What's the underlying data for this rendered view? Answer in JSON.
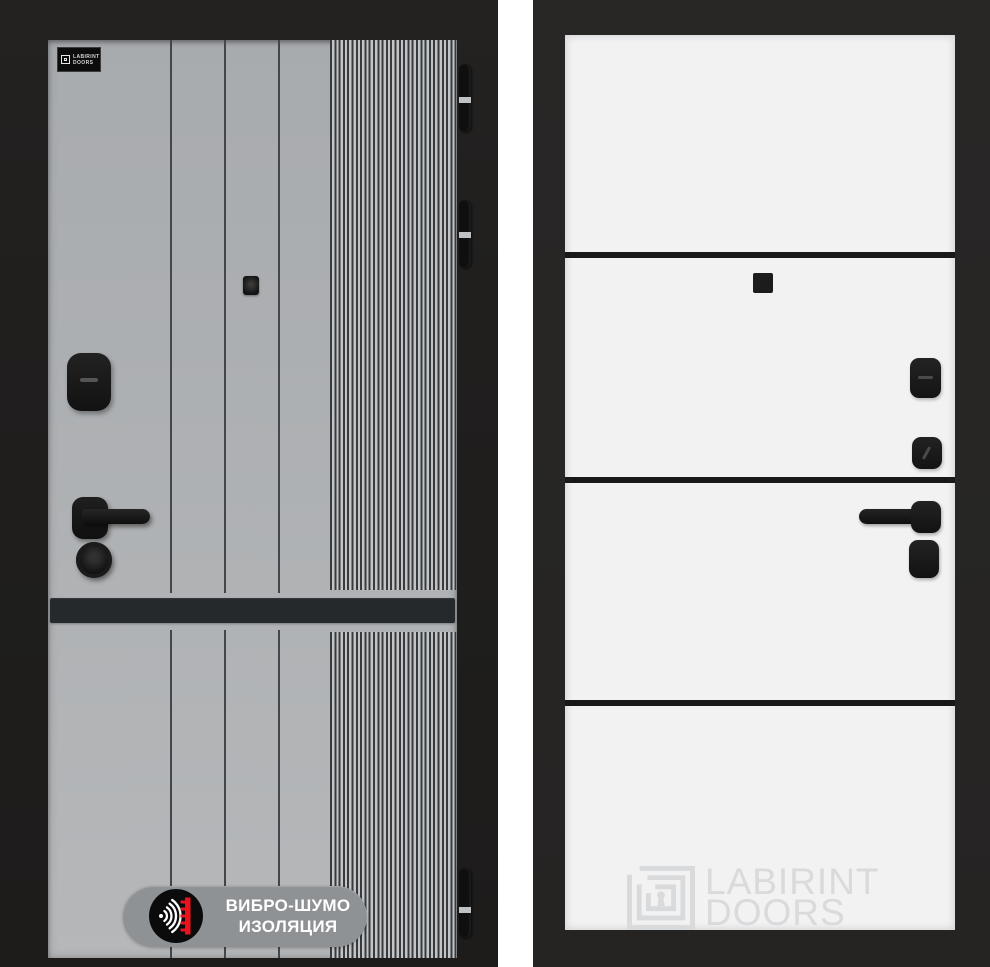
{
  "colors": {
    "page_bg": "#ffffff",
    "left_frame": "#201f1e",
    "panel_gray_top": "#a8abae",
    "panel_gray_bottom": "#b5b7b9",
    "seam_line": "#43464a",
    "rib_dark": "#383b3e",
    "rib_light": "#c2c4c6",
    "accent_stripe": "#26292c",
    "hinge_pin": "#bfc1c3",
    "badge_pill": "#8f9295",
    "badge_icon_bg": "#0b0b0b",
    "badge_wave": "#ffffff",
    "badge_red": "#e8131d",
    "badge_text": "#ffffff",
    "right_frame": "#272625",
    "panel_white": "#f2f2f3",
    "divider": "#191919",
    "watermark": "#d8dadb"
  },
  "icons": {
    "brand_plate": "labirint-logo-icon",
    "badge": "sound-wave-insulation-icon",
    "watermark": "labyrinth-keyhole-icon"
  },
  "left_door": {
    "brand_plate": {
      "line1": "LABIRINT",
      "line2": "DOORS"
    },
    "badge": {
      "line1": "ВИБРО-ШУМО",
      "line2": "ИЗОЛЯЦИЯ"
    },
    "hinge_count": 3
  },
  "right_door": {
    "watermark": {
      "line1": "LABIRINT",
      "line2": "DOORS"
    }
  }
}
